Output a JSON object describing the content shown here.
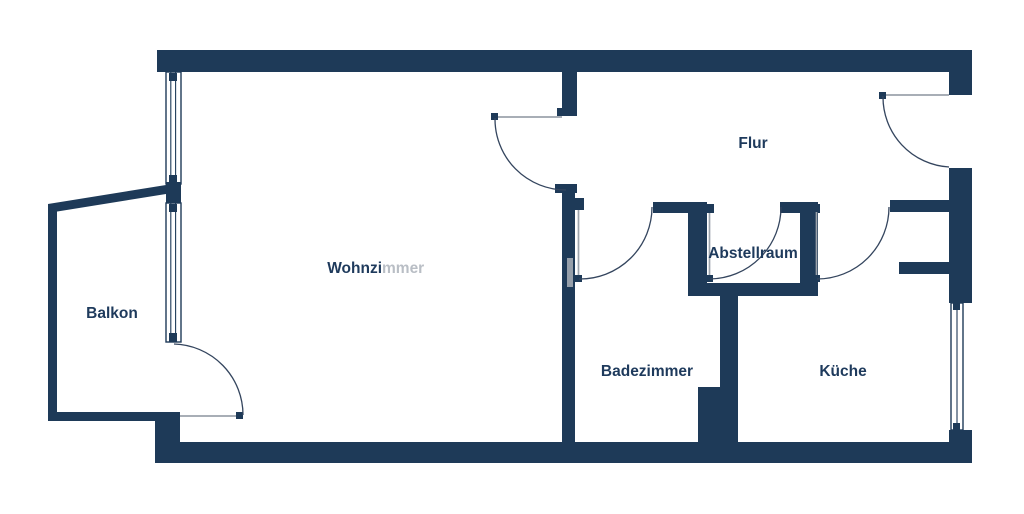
{
  "colors": {
    "wall": "#1E3A58",
    "room_label": "#1E3A5C",
    "room_label_faded": "#B9BEC5",
    "door_leaf": "#9CA3AB",
    "door_arc": "#34455E",
    "background": "#FFFFFF",
    "watermark_artifact": "#ABB1B9"
  },
  "rooms": {
    "wohnzimmer": {
      "label": "Wohnzimmer",
      "label_primary_part": "Wohnzi",
      "label_faded_part": "mmer"
    },
    "balkon": {
      "label": "Balkon"
    },
    "flur": {
      "label": "Flur"
    },
    "abstellraum": {
      "label": "Abstellraum"
    },
    "badezimmer": {
      "label": "Badezimmer"
    },
    "kueche": {
      "label": "Küche"
    }
  },
  "elements": {
    "doors": [
      "balcony-door",
      "living-room-hall-door",
      "apartment-entrance-door",
      "bathroom-door",
      "storage-room-door",
      "kitchen-door"
    ],
    "windows": [
      "living-room-window-upper",
      "living-room-window-lower",
      "kitchen-window"
    ]
  }
}
